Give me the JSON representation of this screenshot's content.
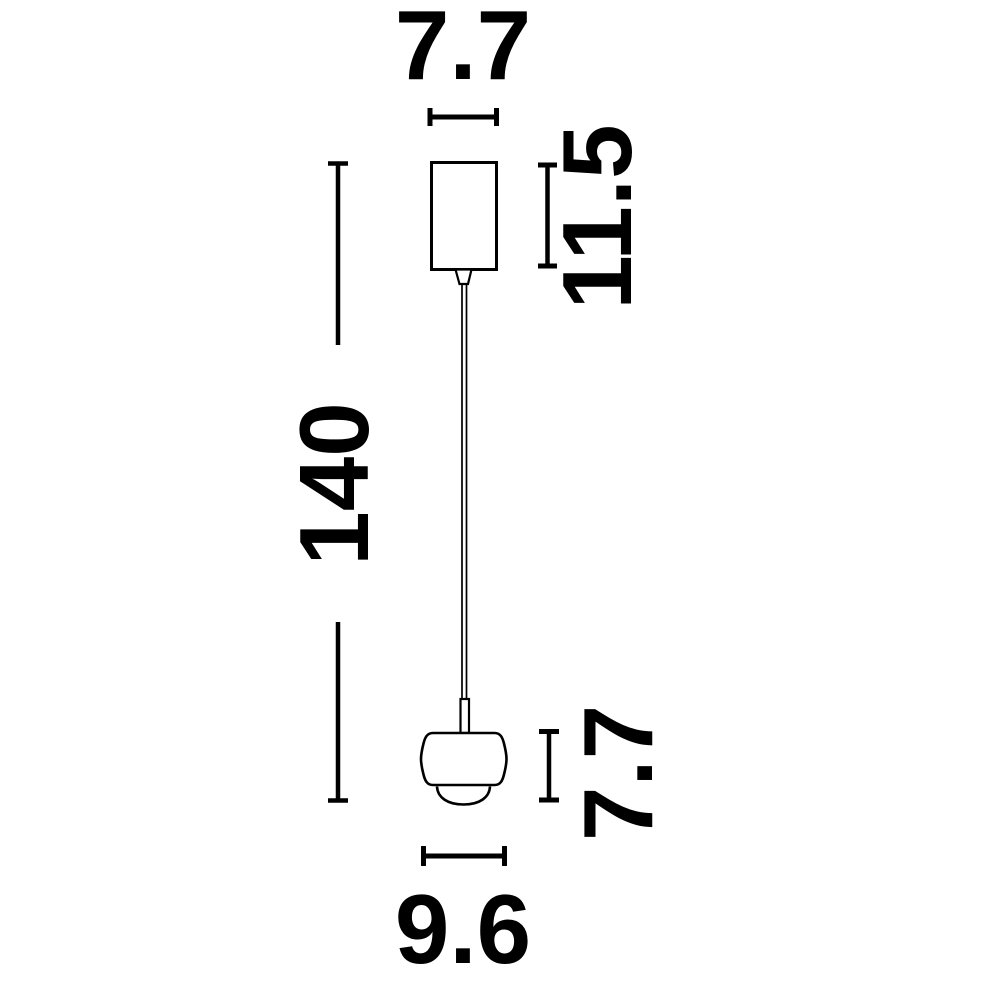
{
  "canvas": {
    "width": 984,
    "height": 985,
    "background_color": "#ffffff",
    "line_color": "#000000"
  },
  "diagram": {
    "kind": "pendant-lamp-dimension-drawing",
    "labels": {
      "canopy_width": "7.7",
      "canopy_height": "11.5",
      "suspension_length": "140",
      "shade_height": "7.7",
      "shade_width": "9.6"
    }
  }
}
